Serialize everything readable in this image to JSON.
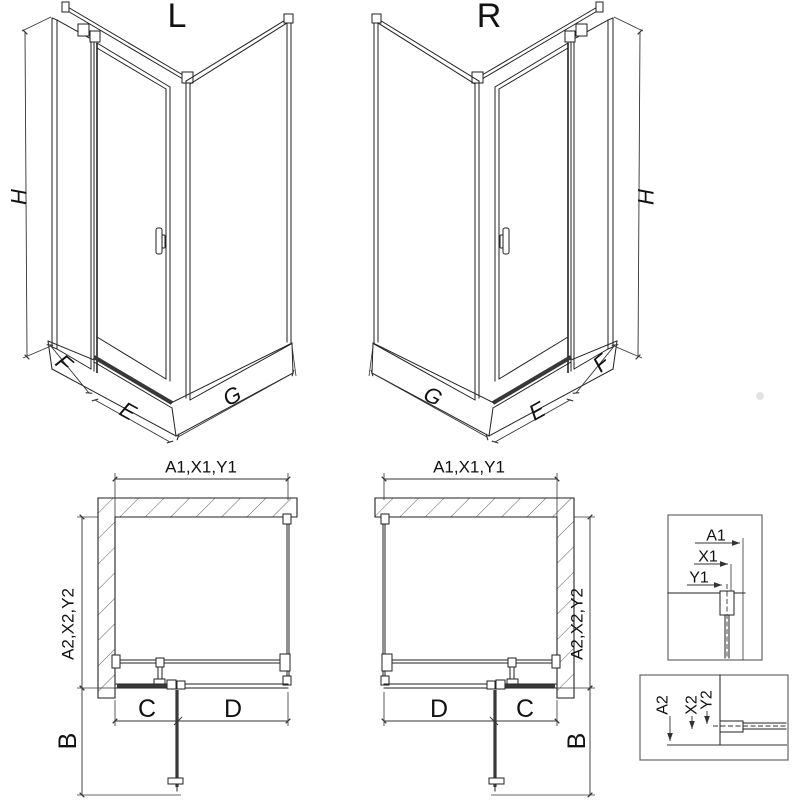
{
  "iso_left": {
    "variant": "L",
    "height_dim": "H",
    "side_dim": "F",
    "front_dim": "E",
    "return_dim": "G"
  },
  "iso_right": {
    "variant": "R",
    "height_dim": "H",
    "side_dim": "F",
    "front_dim": "E",
    "return_dim": "G"
  },
  "plan_left": {
    "width_dims": "A1,X1,Y1",
    "depth_dims": "A2,X2,Y2",
    "fixed_dim": "C",
    "door_dim": "D",
    "swing_dim": "B"
  },
  "plan_right": {
    "width_dims": "A1,X1,Y1",
    "depth_dims": "A2,X2,Y2",
    "fixed_dim": "C",
    "door_dim": "D",
    "swing_dim": "B"
  },
  "detail_width": {
    "labels": [
      "A1",
      "X1",
      "Y1"
    ]
  },
  "detail_depth": {
    "labels": [
      "A2",
      "X2",
      "Y2"
    ]
  },
  "colors": {
    "line": "#222222",
    "dim": "#333333",
    "dark_profile": "#383838",
    "box_border": "#666666",
    "background": "#ffffff",
    "watermark": "#e3e3e3"
  }
}
